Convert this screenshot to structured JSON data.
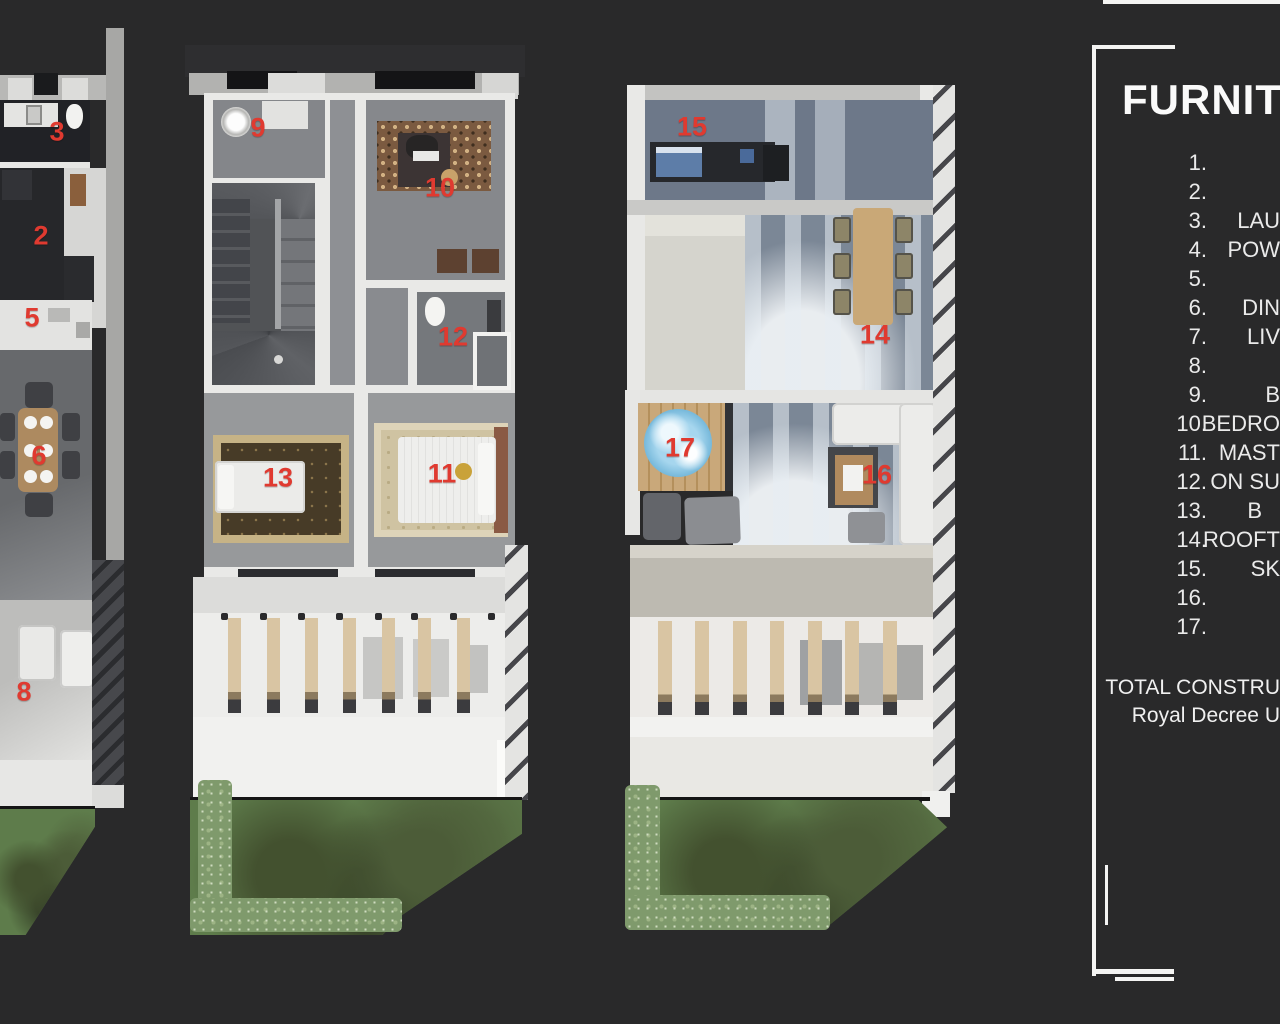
{
  "page": {
    "background": "#29292a"
  },
  "legend": {
    "title": "FURNIT",
    "items": [
      {
        "num": "1.",
        "label": ""
      },
      {
        "num": "2.",
        "label": ""
      },
      {
        "num": "3.",
        "label": "LAU"
      },
      {
        "num": "4.",
        "label": "POW"
      },
      {
        "num": "5.",
        "label": ""
      },
      {
        "num": "6.",
        "label": "DIN"
      },
      {
        "num": "7.",
        "label": "LIV"
      },
      {
        "num": "8.",
        "label": ""
      },
      {
        "num": "9.",
        "label": "B"
      },
      {
        "num": "10.",
        "label": "BEDRO"
      },
      {
        "num": "11.",
        "label": "MAST"
      },
      {
        "num": "12.",
        "label": "ON SU"
      },
      {
        "num": "13.",
        "label": "B"
      },
      {
        "num": "14.",
        "label": "ROOFT"
      },
      {
        "num": "15.",
        "label": "SK"
      },
      {
        "num": "16.",
        "label": ""
      },
      {
        "num": "17.",
        "label": ""
      }
    ],
    "footer_line1": "TOTAL CONSTRU",
    "footer_line2": "Royal Decree U"
  },
  "plans": [
    {
      "name": "ground-floor-plan",
      "markers": [
        {
          "n": "3"
        },
        {
          "n": "2"
        },
        {
          "n": "5"
        },
        {
          "n": "6"
        },
        {
          "n": "8"
        }
      ]
    },
    {
      "name": "first-floor-plan",
      "markers": [
        {
          "n": "9"
        },
        {
          "n": "10"
        },
        {
          "n": "12"
        },
        {
          "n": "13"
        },
        {
          "n": "11"
        }
      ]
    },
    {
      "name": "roof-floor-plan",
      "markers": [
        {
          "n": "15"
        },
        {
          "n": "14"
        },
        {
          "n": "17"
        },
        {
          "n": "16"
        }
      ]
    }
  ],
  "colors": {
    "marker_red": "#e03a30",
    "background": "#29292a",
    "grass": "#5e7c4b",
    "wood": "#c9a87a",
    "water": "#8fc9e8"
  }
}
